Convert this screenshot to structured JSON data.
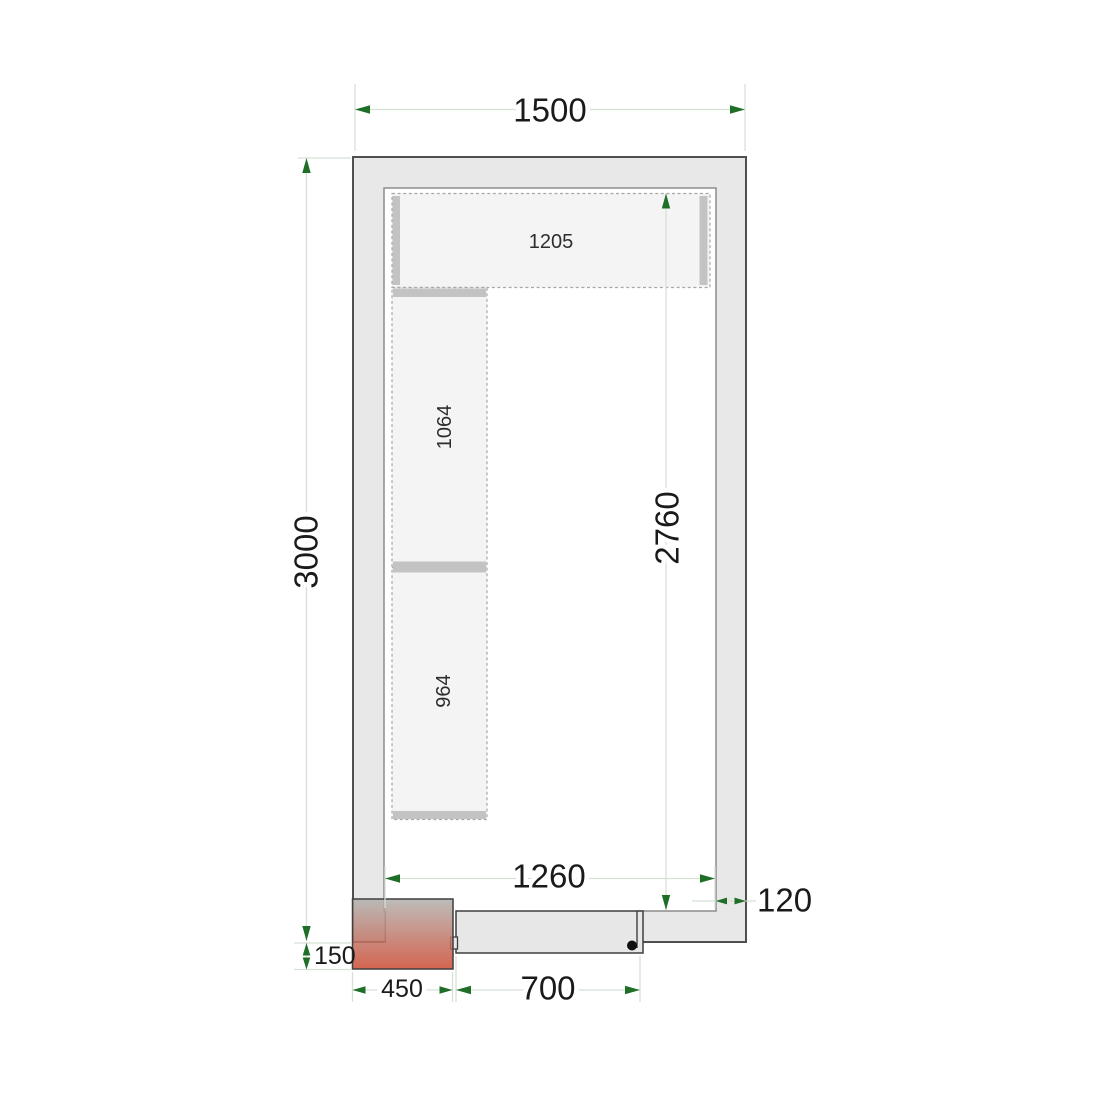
{
  "diagram": {
    "kind": "cold-room-floor-plan",
    "dims": {
      "outer_width": "1500",
      "outer_depth": "3000",
      "inner_width": "1260",
      "inner_depth": "2760",
      "wall_thickness": "120",
      "door_width": "700",
      "unit_width": "450",
      "unit_protrusion": "150"
    },
    "shelves": {
      "top": "1205",
      "left_upper": "1064",
      "left_lower": "964"
    },
    "colors": {
      "wall_fill": "#e8e8e8",
      "wall_stroke": "#4f4f4f",
      "inner_stroke": "#8c8c8c",
      "shelf_fill": "#f4f4f4",
      "shelf_stroke": "#a8a8a8",
      "shelf_edge": "#c3c3c3",
      "door_fill": "#e7e7e7",
      "door_stroke": "#3f3f3f",
      "dim_line": "#d5e1d5",
      "arrow": "#1e6e28",
      "unit_top": "#b2b1ae",
      "unit_bottom": "#cc4a32",
      "hinge_dot": "#111111"
    }
  }
}
